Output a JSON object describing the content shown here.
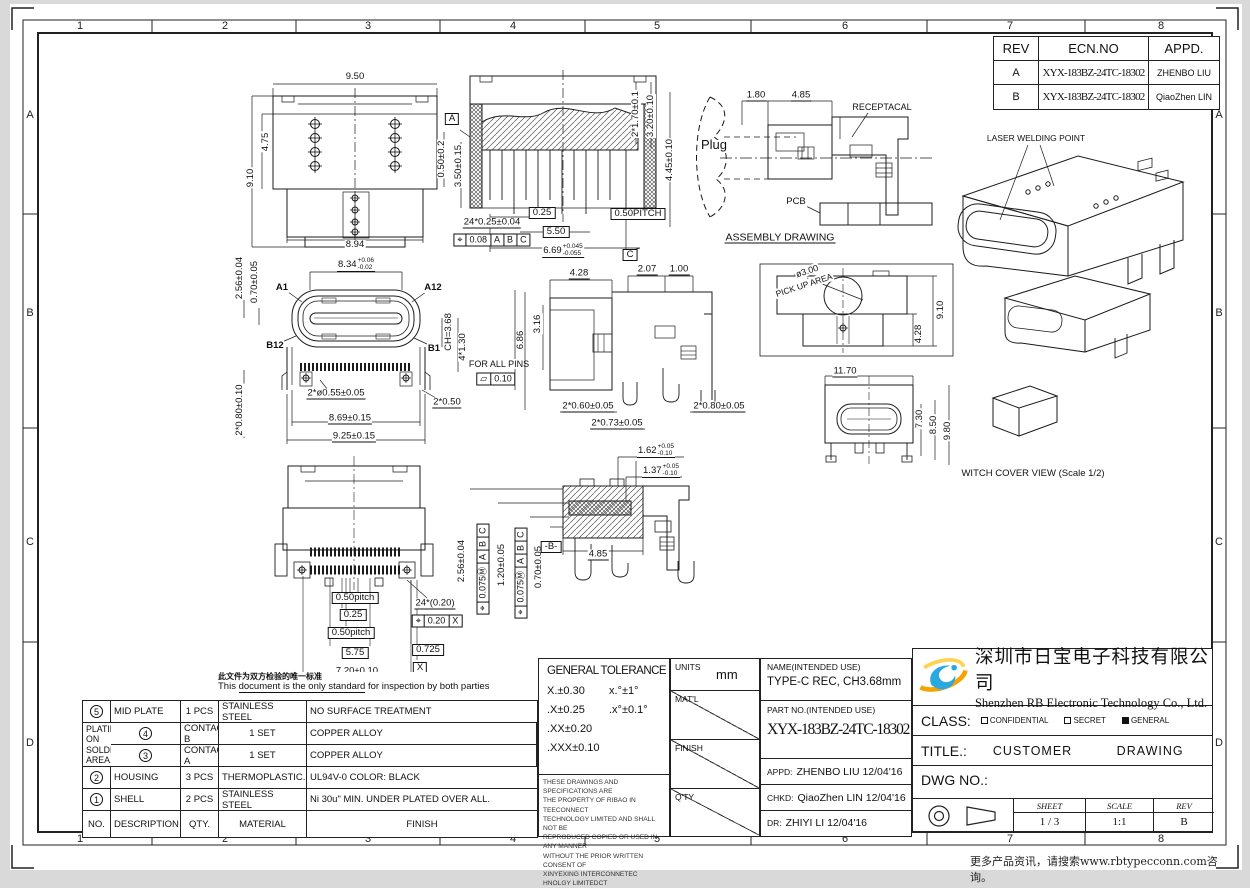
{
  "sheet": {
    "zones_top": [
      "1",
      "2",
      "3",
      "4",
      "5",
      "6",
      "7",
      "8"
    ],
    "zones_bottom": [
      "1",
      "2",
      "3",
      "4",
      "5",
      "6",
      "7",
      "8"
    ],
    "rows_left": [
      "A",
      "B",
      "C",
      "D"
    ],
    "rows_right": [
      "A",
      "B",
      "C",
      "D"
    ],
    "footer_note": "更多产品资讯，请搜索www.rbtypecconn.com咨询。"
  },
  "rev_table": {
    "headers": {
      "rev": "REV",
      "ecn": "ECN.NO",
      "appd": "APPD."
    },
    "rows": [
      {
        "rev": "A",
        "ecn": "XYX-183BZ-24TC-18302",
        "appd": "ZHENBO LIU"
      },
      {
        "rev": "B",
        "ecn": "XYX-183BZ-24TC-18302",
        "appd": "QiaoZhen LIN"
      }
    ]
  },
  "inspection_note": {
    "cn": "此文件为双方检验的唯一标准",
    "en_pre": "This ",
    "en_underlined": "document is the only standard",
    "en_post": " for inspection by both parties"
  },
  "parts_table": {
    "headers": {
      "no": "NO.",
      "description": "DESCRIPTION",
      "qty": "QTY.",
      "material": "MATERIAL",
      "finish": "FINISH"
    },
    "rows": [
      {
        "no": "5",
        "description": "MID PLATE",
        "qty": "1 PCS",
        "material": "STAINLESS STEEL",
        "finish": "NO SURFACE TREATMENT"
      },
      {
        "no": "4",
        "description": "CONTACT B",
        "qty": "1 SET",
        "material": "COPPER ALLOY"
      },
      {
        "no": "3",
        "description": "CONTACT A",
        "qty": "1 SET",
        "material": "COPPER ALLOY"
      },
      {
        "no": "2",
        "description": "HOUSING",
        "qty": "3 PCS",
        "material": "THERMOPLASTIC.",
        "finish": "UL94V-0   COLOR: BLACK"
      },
      {
        "no": "1",
        "description": "SHELL",
        "qty": "2 PCS",
        "material": "STAINLESS STEEL",
        "finish": "Ni 30u\" MIN. UNDER PLATED OVER ALL."
      }
    ],
    "contact_finish": [
      "50u\" MIN. Ni UNDER PLATING.",
      "80u\" MIN. MATTE TIN PLATING ON SOLDER AREA.",
      "GOLD PLATING ON CONTACT AREA.(SEE PART NUM)"
    ]
  },
  "general_tolerance": {
    "title": "GENERAL  TOLERANCE",
    "linear": [
      "X.±0.30",
      ".X±0.25",
      ".XX±0.20",
      ".XXX±0.10"
    ],
    "angular": [
      "x.°±1°",
      ".x°±0.1°"
    ]
  },
  "legal": {
    "lines": [
      "THESE DRAWINGS AND SPECIFICATIONS ARE",
      "THE PROPERTY OF RIBAO IN TEECONNECT",
      "TECHNOLOGY LIMITED AND SHALL NOT BE",
      "REPRODUCED COPIED OR USED IN ANY MANNER",
      "WITHOUT THE PRIOR  WRITTEN CONSENT OF",
      "XINYEXING INTERCONNETEC HNOLGY LIMITEDCT"
    ]
  },
  "title_block": {
    "units_label": "UNITS",
    "units_value": "mm",
    "matl_label": "MAT'L",
    "finish_label": "FINISH",
    "qty_label": "Q'TY",
    "name_label": "NAME(INTENDED USE)",
    "name_value": "TYPE-C REC, CH3.68mm",
    "partno_label": "PART NO.(INTENDED USE)",
    "partno_value": "XYX-183BZ-24TC-18302",
    "appd_label": "APPD:",
    "appd_value": "ZHENBO LIU 12/04'16",
    "chkd_label": "CHKD:",
    "chkd_value": "QiaoZhen LIN 12/04'16",
    "dr_label": "DR:",
    "dr_value": "ZHIYI LI  12/04'16",
    "company_cn": "深圳市日宝电子科技有限公司",
    "company_en": "Shenzhen RB Electronic Technology Co., Ltd.",
    "class_label": "CLASS:",
    "class_options": [
      {
        "label": "CONFIDENTIAL",
        "checked": false
      },
      {
        "label": "SECRET",
        "checked": false
      },
      {
        "label": "GENERAL",
        "checked": true
      }
    ],
    "title_label": "TITLE.:",
    "title_value": "CUSTOMER DRAWING",
    "dwg_label": "DWG NO.:",
    "sheet_label": "SHEET",
    "sheet_value": "1 / 3",
    "scale_label": "SCALE",
    "scale_value": "1:1",
    "rev_label": "REV",
    "rev_value": "B"
  },
  "views": {
    "top_view": {
      "labels": [
        {
          "t": "9.50",
          "x": 115,
          "y": 11
        },
        {
          "t": "4.75",
          "x": 26,
          "y": 76,
          "r": -90
        },
        {
          "t": "9.10",
          "x": 11,
          "y": 112,
          "r": -90
        },
        {
          "t": "8.94",
          "x": 115,
          "y": 179
        }
      ]
    },
    "section_view": {
      "labels": [
        {
          "t": "A",
          "x": 22,
          "y": 57,
          "box": 1
        },
        {
          "t": "0.50±0.2",
          "x": 12,
          "y": 97,
          "r": -90
        },
        {
          "t": "3.50±0.15",
          "x": 29,
          "y": 104,
          "r": -90
        },
        {
          "t": "24*0.25±0.04",
          "x": 62,
          "y": 161,
          "u": 1
        },
        {
          "cells": [
            "⌖",
            "0.08",
            "A",
            "B",
            "C"
          ],
          "x": 62,
          "y": 178
        },
        {
          "t": "0.25",
          "x": 112,
          "y": 151,
          "box": 1
        },
        {
          "t": "5.50",
          "x": 126,
          "y": 170,
          "box": 1
        },
        {
          "t": "6.69",
          "sup": "+0.045",
          "sub": "-0.055",
          "x": 133,
          "y": 189,
          "u": 1
        },
        {
          "t": "C",
          "x": 200,
          "y": 193,
          "box": 1
        },
        {
          "t": "0.50PITCH",
          "x": 208,
          "y": 152,
          "box": 1
        },
        {
          "t": "2*1.70±0.1",
          "x": 206,
          "y": 52,
          "r": -90
        },
        {
          "t": "3.20±0.10",
          "x": 221,
          "y": 54,
          "r": -90
        },
        {
          "t": "4.45±0.10",
          "x": 240,
          "y": 98,
          "r": -90
        }
      ]
    },
    "assembly": {
      "labels": [
        {
          "t": "Plug",
          "x": 34,
          "y": 60,
          "fs": 13
        },
        {
          "t": "1.80",
          "x": 76,
          "y": 11,
          "u": 1
        },
        {
          "t": "4.85",
          "x": 121,
          "y": 11,
          "u": 1
        },
        {
          "t": "RECEPTACAL",
          "x": 202,
          "y": 22,
          "fs": 9
        },
        {
          "t": "PCB",
          "x": 116,
          "y": 117
        },
        {
          "t": "ASSEMBLY DRAWING",
          "x": 100,
          "y": 153,
          "u": 1,
          "fs": 10.5
        }
      ]
    },
    "iso_view": {
      "labels": [
        {
          "t": "LASER WELDING POINT",
          "x": 108,
          "y": 20,
          "fs": 8.5
        }
      ]
    },
    "front_view": {
      "labels": [
        {
          "t": "8.34",
          "sup": "+0.06",
          "sub": "-0.02",
          "x": 126,
          "y": 15,
          "u": 1
        },
        {
          "t": "A1",
          "x": 52,
          "y": 38,
          "b": 1
        },
        {
          "t": "A12",
          "x": 203,
          "y": 38,
          "b": 1
        },
        {
          "t": "B12",
          "x": 45,
          "y": 96,
          "b": 1
        },
        {
          "t": "B1",
          "x": 204,
          "y": 99,
          "b": 1
        },
        {
          "t": "2.56±0.04",
          "x": 10,
          "y": 28,
          "r": -90
        },
        {
          "t": "0.70±0.05",
          "x": 25,
          "y": 32,
          "r": -90
        },
        {
          "t": "CH=3.68",
          "x": 219,
          "y": 82,
          "r": -90
        },
        {
          "t": "4*1.30",
          "x": 233,
          "y": 97,
          "r": -90
        },
        {
          "t": "6.86",
          "x": 291,
          "y": 90,
          "r": -90
        },
        {
          "t": "FOR ALL PINS",
          "x": 269,
          "y": 114,
          "fs": 9
        },
        {
          "cells": [
            "▱",
            "0.10"
          ],
          "x": 266,
          "y": 129
        },
        {
          "t": "2*ø0.55±0.05",
          "x": 106,
          "y": 144,
          "u": 1
        },
        {
          "t": "2*0.50",
          "x": 217,
          "y": 153,
          "u": 1
        },
        {
          "t": "8.69±0.15",
          "x": 120,
          "y": 169,
          "u": 1
        },
        {
          "t": "9.25±0.15",
          "x": 124,
          "y": 187,
          "u": 1
        },
        {
          "t": "2*0.80±0.10",
          "x": 10,
          "y": 160,
          "r": -90
        }
      ]
    },
    "side_view": {
      "labels": [
        {
          "t": "4.28",
          "x": 74,
          "y": 24,
          "u": 1
        },
        {
          "t": "2.07",
          "x": 142,
          "y": 20,
          "u": 1
        },
        {
          "t": "1.00",
          "x": 174,
          "y": 20,
          "u": 1
        },
        {
          "t": "3.16",
          "x": 33,
          "y": 74,
          "r": -90
        },
        {
          "t": "2*0.60±0.05",
          "x": 83,
          "y": 157,
          "u": 1
        },
        {
          "t": "2*0.73±0.05",
          "x": 112,
          "y": 174,
          "u": 1
        },
        {
          "t": "2*0.80±0.05",
          "x": 214,
          "y": 157,
          "u": 1
        }
      ]
    },
    "pickup_area": {
      "labels": [
        {
          "t": "ø3.00",
          "x": 52,
          "y": 13,
          "r": -18,
          "fs": 9
        },
        {
          "t": "PICK UP AREA",
          "x": 49,
          "y": 27,
          "r": -18,
          "fs": 8.5
        },
        {
          "t": "9.10",
          "x": 186,
          "y": 52,
          "r": -90
        },
        {
          "t": "4.28",
          "x": 164,
          "y": 76,
          "r": -90
        },
        {
          "t": "11.70",
          "x": 90,
          "y": 114,
          "u": 1
        },
        {
          "t": "7.30",
          "x": 165,
          "y": 161,
          "r": -90
        },
        {
          "t": "8.50",
          "x": 179,
          "y": 167,
          "r": -90
        },
        {
          "t": "9.80",
          "x": 193,
          "y": 173,
          "r": -90
        },
        {
          "t": "WITCH COVER VIEW (Scale 1/2)",
          "x": 278,
          "y": 216,
          "fs": 9.5
        }
      ]
    },
    "bottom_view": {
      "labels": [
        {
          "t": "0.50pitch",
          "x": 90,
          "y": 150,
          "box": 1
        },
        {
          "t": "0.25",
          "x": 88,
          "y": 167,
          "box": 1
        },
        {
          "t": "0.50pitch",
          "x": 86,
          "y": 185,
          "box": 1
        },
        {
          "t": "5.75",
          "x": 90,
          "y": 205,
          "box": 1
        },
        {
          "t": "7.20±0.10",
          "x": 92,
          "y": 224,
          "u": 1
        },
        {
          "t": "24*(0.20)",
          "x": 170,
          "y": 156,
          "u": 1
        },
        {
          "cells": [
            "⌖",
            "0.20",
            "X"
          ],
          "x": 172,
          "y": 173
        },
        {
          "t": "0.725",
          "x": 163,
          "y": 202,
          "box": 1
        },
        {
          "t": "X",
          "x": 155,
          "y": 220,
          "box": 1
        }
      ]
    },
    "rear_section": {
      "labels": [
        {
          "t": "1.62",
          "sup": "+0.05",
          "sub": "-0.10",
          "x": 206,
          "y": 18,
          "u": 1
        },
        {
          "t": "1.37",
          "sup": "+0.05",
          "sub": "-0.10",
          "x": 211,
          "y": 38,
          "u": 1
        },
        {
          "t": "4.85",
          "x": 148,
          "y": 122,
          "u": 1
        },
        {
          "t": "2.56±0.04",
          "x": 12,
          "y": 128,
          "r": -90
        },
        {
          "cells": [
            "⌖",
            "0.075Ⓜ",
            "A",
            "B",
            "C"
          ],
          "x": 33,
          "y": 136,
          "r": -90
        },
        {
          "t": "1.20±0.05",
          "x": 52,
          "y": 132,
          "r": -90
        },
        {
          "cells": [
            "⌖",
            "0.075Ⓜ",
            "A",
            "B",
            "C"
          ],
          "x": 71,
          "y": 140,
          "r": -90
        },
        {
          "t": "0.70±0.05",
          "x": 89,
          "y": 134,
          "r": -90
        },
        {
          "t": "-B-",
          "x": 101,
          "y": 114,
          "box": 1
        }
      ]
    }
  }
}
